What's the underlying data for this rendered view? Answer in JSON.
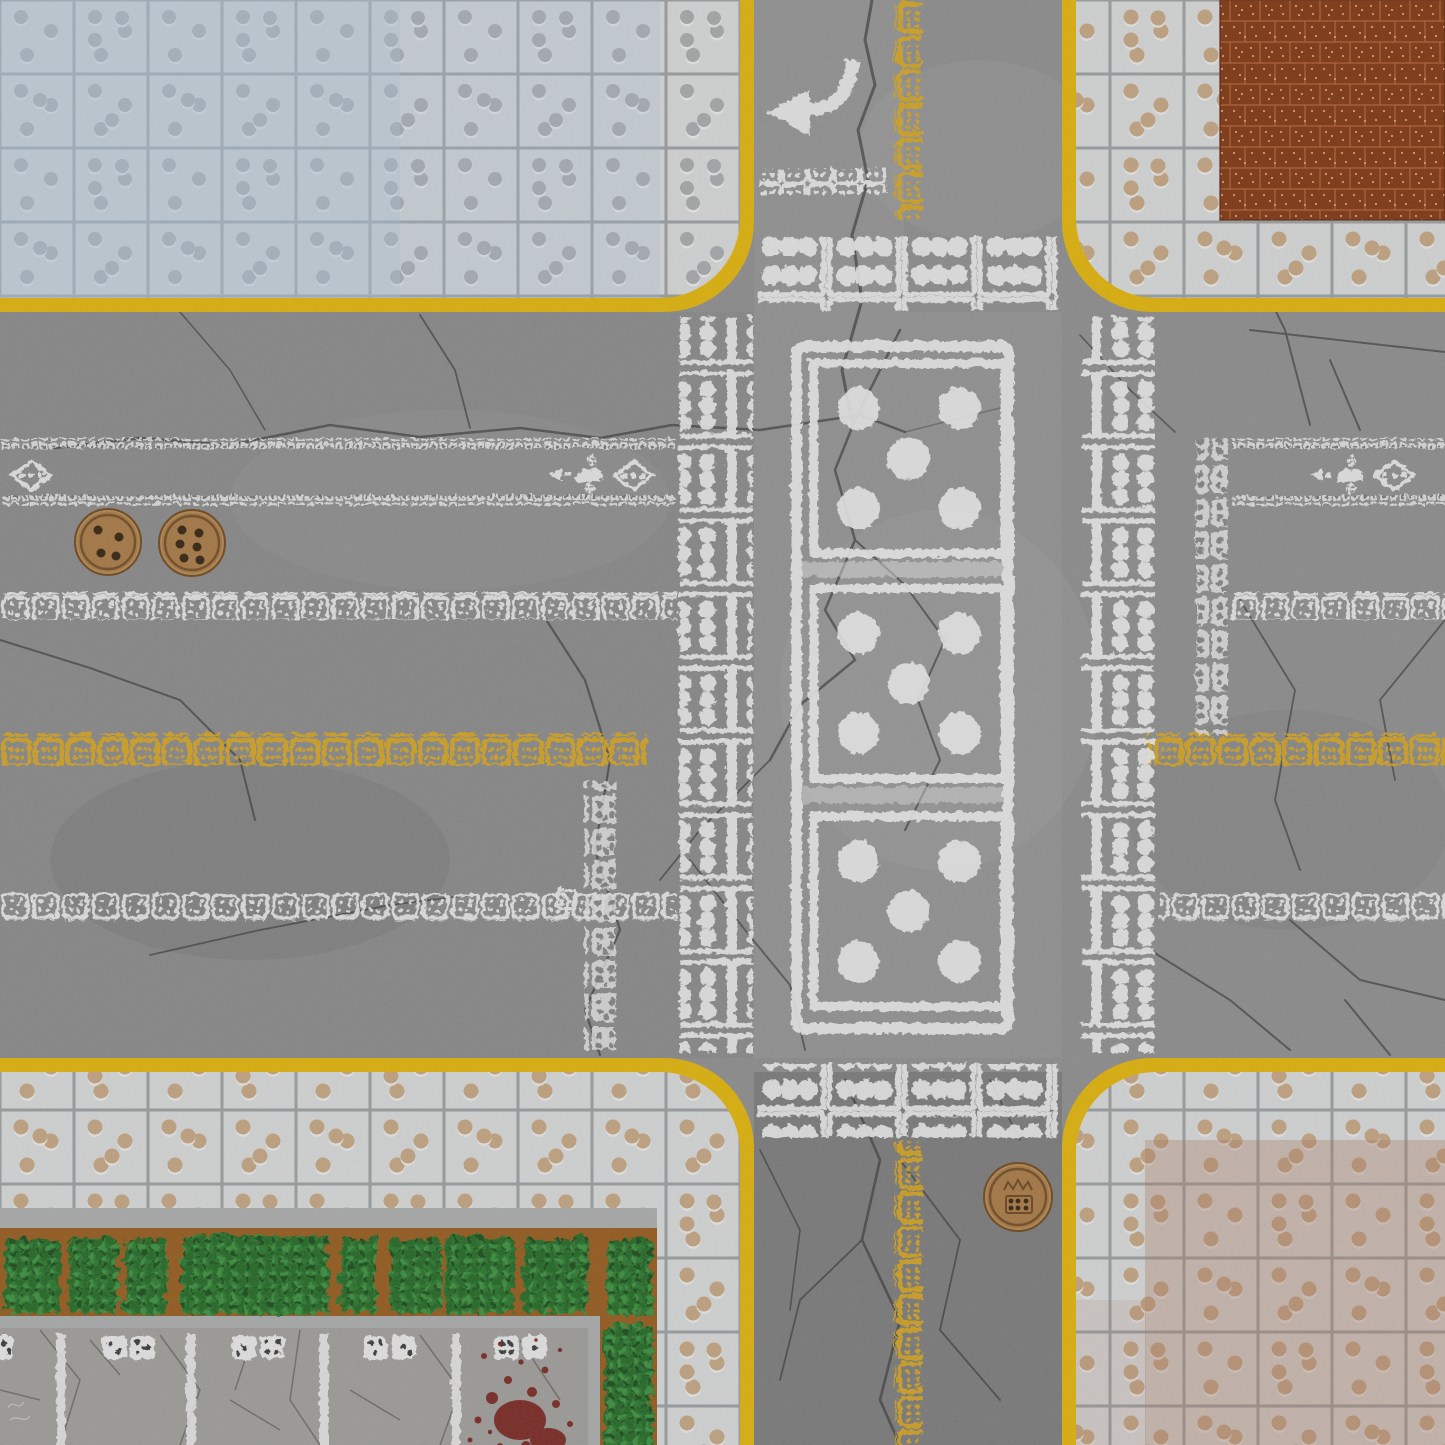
{
  "meta": {
    "title": "Domino Crossroads Game Mat",
    "description": "Top-down tabletop battle mat of a cracked asphalt street intersection where all road markings are domino and dice motifs: pip crosswalks, a giant three-section domino painted in the junction, dice-face manholes, tiled sidewalks with recessed pips, a red perforated brick patch, hedges and a parking lot with a blood splatter."
  },
  "colors": {
    "asphalt": "#999999",
    "crack": "#343434",
    "curb": "#f2c10a",
    "markWhite": "#ffffff",
    "markYellow": "#eab31e",
    "grout": "#a6abae",
    "tile": "#e7e8e8",
    "tileBlue": "#b9d4e8",
    "pipGray": "#b4b6b8",
    "pipTan": "#d3b28c",
    "pipHighlight": "#ffffff",
    "brick": "#8a3a12",
    "brickGrout": "#c4693a",
    "brickDot": "#eda87a",
    "rust": "#b97f63",
    "stone": "#b7bab8",
    "soil": "#a2611f",
    "soilDark": "#7c451a",
    "hedge": "#2e8133",
    "hedgeDark": "#256f28",
    "hedgeLight": "#3f9a42",
    "hedgeDeep": "#1b511d",
    "concrete": "#abaaa5",
    "concreteCrack": "#63635c",
    "blood": "#7e150f",
    "manhole": "#b5834a",
    "manholeRing": "#6b431c",
    "manholePip": "#3a2410"
  },
  "scene": {
    "roads": {
      "vertical_road_x": [
        754,
        1062
      ],
      "horizontal_road_y": [
        312,
        1058
      ],
      "curb_thickness_px": 14,
      "corner_radius_px": 85
    },
    "markings": {
      "turn_arrow": {
        "direction": "left",
        "approx_center": [
          810,
          96
        ]
      },
      "stop_line": {
        "squares": 5,
        "pips_each": 4
      },
      "crosswalks": {
        "count": 2,
        "boxes_per_crosswalk": 4,
        "pips_per_box": 6
      },
      "central_domino": {
        "faces": [
          5,
          5,
          5
        ],
        "sections": 3
      },
      "intersection_pip_columns": {
        "count": 2,
        "cells_each": 10,
        "pips_per_cell": 6
      },
      "lane_dot_lines_y": [
        437,
        494
      ],
      "white_dash_rows_y": [
        591,
        892
      ],
      "yellow_dash_row_y": 732,
      "yellow_dash_column_x": 893,
      "diamond_symbols": [
        {
          "cx": 30,
          "cy": 474,
          "dots": 3
        },
        {
          "cx": 632,
          "cy": 474,
          "dots": 3
        },
        {
          "cx": 1393,
          "cy": 474,
          "dots": 3
        }
      ],
      "arrow_glyphs": [
        {
          "cx": 572,
          "cy": 473,
          "direction": "left",
          "dice_diamonds": 2
        },
        {
          "cx": 1333,
          "cy": 473,
          "direction": "left",
          "dice_diamonds": 2
        }
      ],
      "approach_strips": [
        {
          "x": 583,
          "y_range": [
            779,
            1049
          ]
        },
        {
          "x": 1195,
          "y_range": [
            437,
            733
          ]
        }
      ]
    },
    "props": {
      "manholes": [
        {
          "cx": 108,
          "cy": 542,
          "r": 33,
          "pips": 4
        },
        {
          "cx": 192,
          "cy": 543,
          "r": 33,
          "pips": 6
        },
        {
          "cx": 1018,
          "cy": 1197,
          "r": 34,
          "pips": 6,
          "emblem": "crown-and-domino"
        }
      ],
      "blood_splatter": {
        "approx_center": [
          520,
          1400
        ]
      },
      "parking_lot": {
        "bay_lines_x": [
          59,
          189,
          322,
          454
        ],
        "domino_pair_centers_x": [
          125,
          255,
          386,
          517
        ]
      },
      "hedge": {
        "shape": "L",
        "bush_segments": 9
      },
      "red_brick_patch": {
        "x_range": [
          1220,
          1445
        ],
        "y_range": [
          0,
          220
        ]
      }
    },
    "sidewalks": {
      "tile_size_px": 74,
      "top_left_tint": "blue",
      "top_right_feature": "red_brick_patch",
      "bottom_left_features": [
        "hedge_planter",
        "parking_lot",
        "blood_splatter"
      ],
      "bottom_right_tint": "rust"
    }
  }
}
